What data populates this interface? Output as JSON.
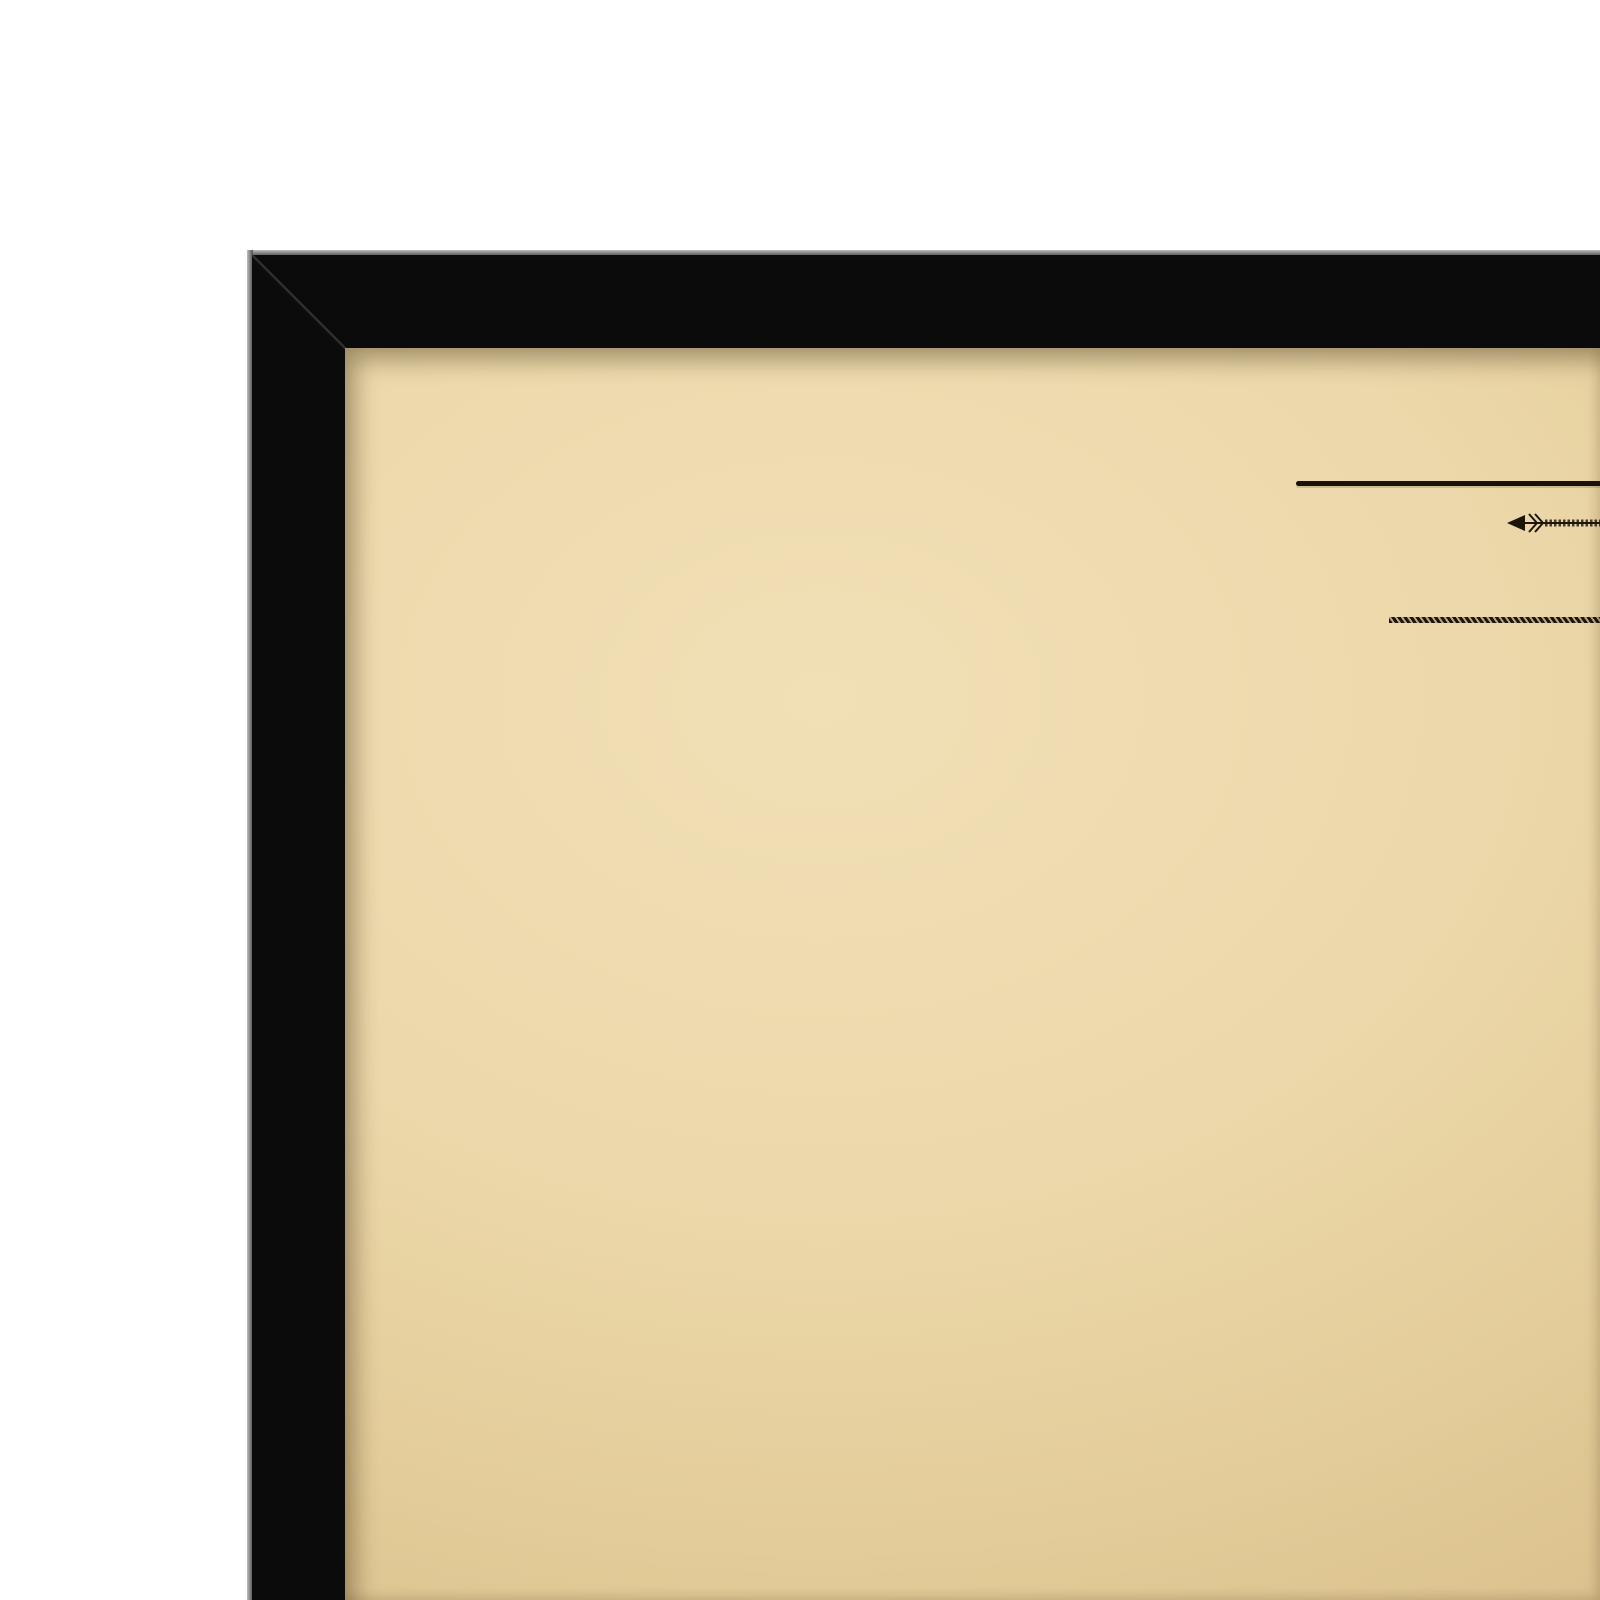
{
  "scene": {
    "description": "Framed vintage street map print, top-left corner view",
    "background_color": "#ffffff",
    "frame_color": "#0b0b0b",
    "frame_bevel_color": "#5a5a5a",
    "paper_color": "#ecd8aa",
    "ink_color": "#2d2214"
  },
  "header": {
    "title_word_1": "MELBOURNE",
    "title_word_and": "AND",
    "title_word_2": "MET",
    "subtitle_visible": "MELBOURNE, FITZROY, COLL",
    "catalog_number": "5886 | 070 | 8995"
  },
  "map": {
    "labels": [
      {
        "t": "ROAD",
        "x": 547,
        "y": 754,
        "s": 8,
        "ls": 5
      },
      {
        "t": "DEPOT",
        "x": 601,
        "y": 752,
        "s": 5.5,
        "ls": 1
      },
      {
        "t": "BRUNSWICK",
        "x": 664,
        "y": 761,
        "s": 8,
        "ls": 5
      },
      {
        "t": "ROAD",
        "x": 1532,
        "y": 764,
        "s": 8,
        "ls": 5
      },
      {
        "t": "STREET",
        "x": 520,
        "y": 864,
        "s": 8,
        "ls": 8
      },
      {
        "t": "PARK",
        "x": 757,
        "y": 867,
        "s": 8,
        "ls": 8
      },
      {
        "t": "ROAD",
        "x": 568,
        "y": 952,
        "s": 7.5,
        "ls": 4,
        "rot": -90
      },
      {
        "t": "STREET",
        "x": 1048,
        "y": 1022,
        "s": 7,
        "ls": 4,
        "rot": -90
      },
      {
        "t": "STREET",
        "x": 1143,
        "y": 1036,
        "s": 7,
        "ls": 4,
        "rot": -90
      },
      {
        "t": "STREET",
        "x": 958,
        "y": 1090,
        "s": 7,
        "ls": 4,
        "rot": -90
      },
      {
        "t": "STREET",
        "x": 1335,
        "y": 994,
        "s": 7,
        "ls": 4,
        "rot": -90
      },
      {
        "t": "STREET",
        "x": 1449,
        "y": 820,
        "s": 7,
        "ls": 4,
        "rot": -90
      },
      {
        "t": "STREET",
        "x": 1545,
        "y": 824,
        "s": 7,
        "ls": 4,
        "rot": -90
      },
      {
        "t": "LANE",
        "x": 1074,
        "y": 983,
        "s": 6.5,
        "ls": 2
      },
      {
        "t": "ST.",
        "x": 1132,
        "y": 984,
        "s": 6.5,
        "ls": 1
      },
      {
        "t": "STREET",
        "x": 1196,
        "y": 1105,
        "s": 7.5,
        "ls": 5
      },
      {
        "t": "PIGDON",
        "x": 790,
        "y": 1236,
        "s": 8,
        "ls": 5
      },
      {
        "t": "STREET",
        "x": 1289,
        "y": 1242,
        "s": 7.5,
        "ls": 5
      },
      {
        "t": "PIGDON",
        "x": 1372,
        "y": 1243,
        "s": 7.5,
        "ls": 5
      },
      {
        "t": "PATTERSON",
        "x": 908,
        "y": 1410,
        "s": 8,
        "ls": 5
      },
      {
        "t": "STREET",
        "x": 1203,
        "y": 1410,
        "s": 7.5,
        "ls": 5
      },
      {
        "t": "RICHARDSON",
        "x": 917,
        "y": 1575,
        "s": 8,
        "ls": 5
      },
      {
        "t": "ST",
        "x": 1264,
        "y": 1576,
        "s": 7,
        "ls": 2
      },
      {
        "t": "RICHARDSON",
        "x": 1380,
        "y": 1579,
        "s": 7.5,
        "ls": 5
      },
      {
        "t": "TERESA",
        "x": 428,
        "y": 1325,
        "s": 7,
        "ls": 4
      },
      {
        "t": "ST",
        "x": 502,
        "y": 1327,
        "s": 7,
        "ls": 1
      },
      {
        "t": "HOLTOM",
        "x": 806,
        "y": 1098,
        "s": 7,
        "ls": 3,
        "rot": 40
      },
      {
        "t": "Princes",
        "x": 648,
        "y": 1046,
        "s": 11,
        "ls": 5,
        "cls": "place"
      },
      {
        "t": "Park",
        "x": 739,
        "y": 1041,
        "s": 11,
        "ls": 4,
        "cls": "place"
      },
      {
        "t": "Princes",
        "x": 764,
        "y": 1572,
        "s": 9,
        "ls": 7,
        "cls": "place"
      },
      {
        "t": "Park",
        "x": 827,
        "y": 1570,
        "s": 9,
        "ls": 5,
        "cls": "place"
      },
      {
        "t": "Plantation",
        "x": 670,
        "y": 962,
        "s": 6,
        "cls": "annot"
      },
      {
        "t": "Bowling Green",
        "x": 700,
        "y": 1046,
        "s": 6,
        "cls": "annot"
      },
      {
        "t": "Plantation",
        "x": 664,
        "y": 1312,
        "s": 5.5,
        "cls": "annot"
      },
      {
        "t": "Plantation",
        "x": 753,
        "y": 1358,
        "s": 5.5,
        "cls": "annot"
      },
      {
        "t": "To Whittlesea",
        "x": 1328,
        "y": 870,
        "s": 7,
        "cls": "hand"
      },
      {
        "t": "Route altered by Act 1906",
        "x": 1497,
        "y": 922,
        "s": 7,
        "cls": "hand"
      },
      {
        "t": "Route altered",
        "x": 784,
        "y": 885,
        "s": 6,
        "cls": "hand"
      }
    ]
  }
}
